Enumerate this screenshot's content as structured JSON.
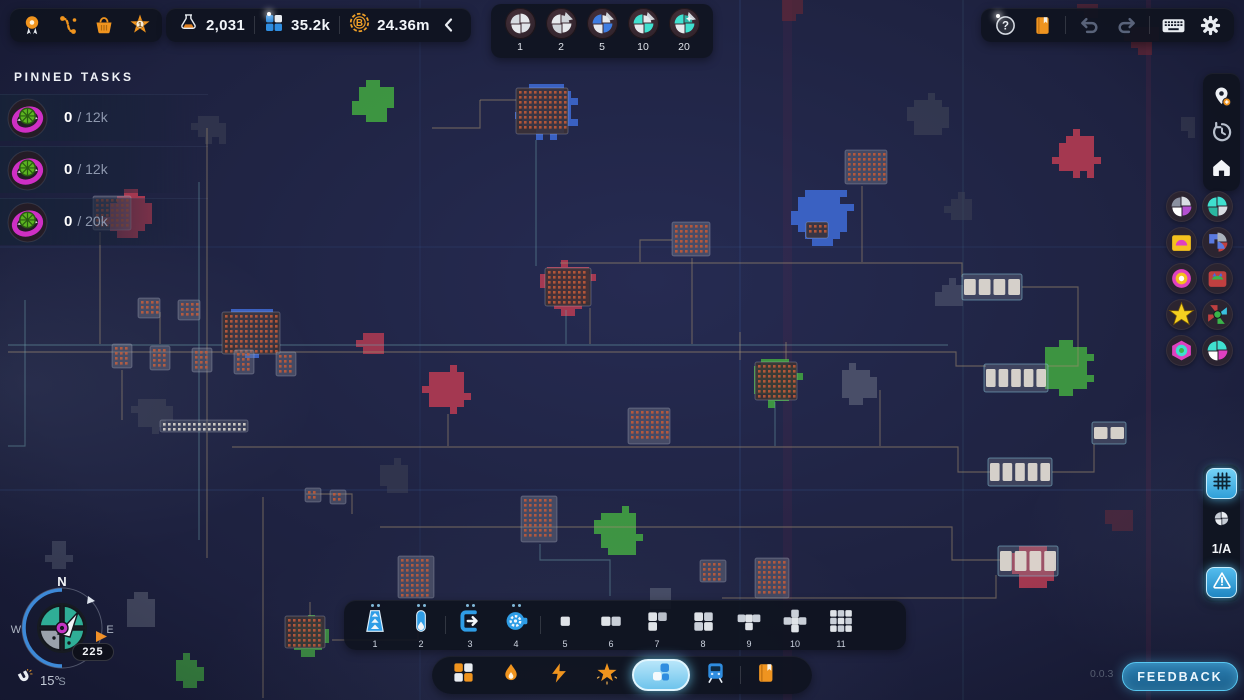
{
  "meta": {
    "version": "0.0.3"
  },
  "topbar": {
    "star_level": "1",
    "resources": {
      "research": "2,031",
      "shapes": "35.2k",
      "currency": "24.36m"
    }
  },
  "shape_selector": {
    "items": [
      {
        "label": "1",
        "colors": [
          "#e6e9ed",
          "#dfe3e8",
          "#e6e9ed",
          "#d6dbe1"
        ],
        "spike": false,
        "star": false
      },
      {
        "label": "2",
        "colors": [
          "#e6e9ed",
          "#cfd4da",
          "#e6e9ed",
          "#cfd4da"
        ],
        "spike": true,
        "star": false
      },
      {
        "label": "5",
        "colors": [
          "#3e7de2",
          "#e6e9ed",
          "#3e7de2",
          "#e6e9ed"
        ],
        "spike": true,
        "star": false
      },
      {
        "label": "10",
        "colors": [
          "#3fe0cf",
          "#e6e9ed",
          "#3fe0cf",
          "#e6e9ed"
        ],
        "spike": true,
        "star": false
      },
      {
        "label": "20",
        "colors": [
          "#3fe0cf",
          "#e6e9ed",
          "#3fe0cf",
          "#2ab6a8"
        ],
        "spike": true,
        "star": true
      }
    ]
  },
  "pinned": {
    "title": "PINNED TASKS",
    "tasks": [
      {
        "current": "0",
        "rest": "/ 12k"
      },
      {
        "current": "0",
        "rest": "/ 12k"
      },
      {
        "current": "0",
        "rest": "/ 20k"
      }
    ]
  },
  "right_panel": {
    "layer": "1/A",
    "badges": [
      {
        "colors": [
          "#d9dde3",
          "#b44fd0",
          "#ffffff",
          "#8a90a0"
        ],
        "type": "quad"
      },
      {
        "colors": [
          "#3fe0cf",
          "#d9dde3",
          "#2ab6a0",
          "#3fe0cf"
        ],
        "type": "quad"
      },
      {
        "colors": [
          "#f5c11e",
          "#e040c0",
          "#f5c11e",
          "#ffffff"
        ],
        "type": "quad"
      },
      {
        "colors": [
          "#5a7ae0",
          "#aab2bc",
          "#c04040",
          "#5a7ae0"
        ],
        "type": "quad"
      },
      {
        "colors": [
          "#e040c0",
          "#f5c11e",
          "#ffffff",
          "#e040c0"
        ],
        "type": "quad"
      },
      {
        "colors": [
          "#c04040",
          "#3ab54a",
          "#4a6ae0",
          "#c04040"
        ],
        "type": "quad"
      },
      {
        "colors": [
          "#f5d020"
        ],
        "type": "star"
      },
      {
        "colors": [
          "#c04040",
          "#39c0e0",
          "#3ab54a",
          "#c04040"
        ],
        "type": "quad"
      },
      {
        "colors": [
          "#e040c0",
          "#3fe0cf",
          "#3ab54a",
          "#e040c0"
        ],
        "type": "quad"
      },
      {
        "colors": [
          "#3fe0cf",
          "#e040c0",
          "#ffffff",
          "#3fe0cf"
        ],
        "type": "quad"
      }
    ]
  },
  "toolbar": {
    "items": [
      {
        "num": "1"
      },
      {
        "num": "2"
      },
      {
        "num": "3"
      },
      {
        "num": "4"
      },
      {
        "num": "5"
      },
      {
        "num": "6"
      },
      {
        "num": "7"
      },
      {
        "num": "8"
      },
      {
        "num": "9"
      },
      {
        "num": "10"
      },
      {
        "num": "11"
      }
    ]
  },
  "compass": {
    "n": "N",
    "w": "W",
    "e": "E",
    "s": "S",
    "heading": "225",
    "tilt": "15°"
  },
  "footer": {
    "feedback": "FEEDBACK"
  },
  "accents": {
    "blue": "#2f9de6",
    "orange": "#f0941e",
    "selected_glow": "#6ec4ec"
  },
  "map": {
    "colors": {
      "red": "#b23b52",
      "green": "#3f9b41",
      "blue": "#3c64c8",
      "gray": "#6a7082",
      "dgray": "#3f4456",
      "dred": "#6a2836"
    },
    "stripes": [
      {
        "x": 783,
        "w": 9,
        "a": 0.07
      },
      {
        "x": 1146,
        "w": 5,
        "a": 0.1
      }
    ],
    "grid": [
      {
        "v": 420,
        "a": 0.1
      },
      {
        "v": 740,
        "a": 0.2
      },
      {
        "v": 963,
        "a": 0.14,
        "t": "teal"
      },
      {
        "h": 247,
        "a": 0.13
      },
      {
        "h": 490,
        "a": 0.18
      }
    ],
    "blobs": [
      {
        "x": 375,
        "y": 103,
        "r": 20,
        "c": "green",
        "a": 0.95
      },
      {
        "x": 548,
        "y": 110,
        "r": 30,
        "c": "blue",
        "a": 0.95
      },
      {
        "x": 930,
        "y": 116,
        "r": 20,
        "c": "dgray",
        "a": 0.6
      },
      {
        "x": 1078,
        "y": 155,
        "r": 23,
        "c": "red",
        "a": 0.9
      },
      {
        "x": 1142,
        "y": 38,
        "r": 15,
        "c": "dred",
        "a": 0.7
      },
      {
        "x": 1188,
        "y": 124,
        "r": 11,
        "c": "dgray",
        "a": 0.5
      },
      {
        "x": 210,
        "y": 128,
        "r": 16,
        "c": "dgray",
        "a": 0.5
      },
      {
        "x": 130,
        "y": 216,
        "r": 24,
        "c": "red",
        "a": 0.9
      },
      {
        "x": 822,
        "y": 214,
        "r": 28,
        "c": "blue",
        "a": 0.95
      },
      {
        "x": 252,
        "y": 330,
        "r": 25,
        "c": "blue",
        "a": 0.95
      },
      {
        "x": 568,
        "y": 288,
        "r": 25,
        "c": "red",
        "a": 0.9
      },
      {
        "x": 372,
        "y": 342,
        "r": 13,
        "c": "red",
        "a": 0.85
      },
      {
        "x": 447,
        "y": 390,
        "r": 22,
        "c": "red",
        "a": 0.9
      },
      {
        "x": 152,
        "y": 413,
        "r": 18,
        "c": "dgray",
        "a": 0.55
      },
      {
        "x": 960,
        "y": 208,
        "r": 13,
        "c": "dgray",
        "a": 0.5
      },
      {
        "x": 775,
        "y": 380,
        "r": 25,
        "c": "green",
        "a": 0.95
      },
      {
        "x": 858,
        "y": 386,
        "r": 20,
        "c": "gray",
        "a": 0.55
      },
      {
        "x": 1068,
        "y": 370,
        "r": 27,
        "c": "green",
        "a": 0.95
      },
      {
        "x": 952,
        "y": 295,
        "r": 14,
        "c": "gray",
        "a": 0.4
      },
      {
        "x": 620,
        "y": 532,
        "r": 23,
        "c": "green",
        "a": 0.95
      },
      {
        "x": 392,
        "y": 477,
        "r": 16,
        "c": "dgray",
        "a": 0.5
      },
      {
        "x": 1032,
        "y": 566,
        "r": 24,
        "c": "red",
        "a": 0.9
      },
      {
        "x": 140,
        "y": 612,
        "r": 17,
        "c": "gray",
        "a": 0.5
      },
      {
        "x": 188,
        "y": 672,
        "r": 16,
        "c": "green",
        "a": 0.8
      },
      {
        "x": 310,
        "y": 638,
        "r": 20,
        "c": "green",
        "a": 0.85
      },
      {
        "x": 660,
        "y": 598,
        "r": 14,
        "c": "gray",
        "a": 0.5
      },
      {
        "x": 1122,
        "y": 520,
        "r": 14,
        "c": "dred",
        "a": 0.5
      },
      {
        "x": 790,
        "y": 8,
        "r": 12,
        "c": "dred",
        "a": 0.6
      },
      {
        "x": 1090,
        "y": 10,
        "r": 10,
        "c": "dred",
        "a": 0.6
      },
      {
        "x": 60,
        "y": 556,
        "r": 12,
        "c": "gray",
        "a": 0.4
      }
    ],
    "lines": [
      {
        "p": [
          [
            8,
            352
          ],
          [
            956,
            352
          ],
          [
            956,
            366
          ],
          [
            986,
            366
          ]
        ],
        "c": 1
      },
      {
        "p": [
          [
            8,
            345
          ],
          [
            948,
            345
          ]
        ],
        "c": 2
      },
      {
        "p": [
          [
            560,
            263
          ],
          [
            962,
            263
          ],
          [
            962,
            277
          ]
        ],
        "c": 1
      },
      {
        "p": [
          [
            232,
            447
          ],
          [
            958,
            447
          ],
          [
            958,
            472
          ],
          [
            990,
            472
          ]
        ],
        "c": 1
      },
      {
        "p": [
          [
            380,
            527
          ],
          [
            952,
            527
          ],
          [
            952,
            560
          ],
          [
            1000,
            560
          ]
        ],
        "c": 1
      },
      {
        "p": [
          [
            722,
            598
          ],
          [
            996,
            598
          ],
          [
            996,
            575
          ]
        ],
        "c": 1
      },
      {
        "p": [
          [
            207,
            128
          ],
          [
            207,
            558
          ]
        ],
        "c": 1
      },
      {
        "p": [
          [
            199,
            182
          ],
          [
            199,
            540
          ]
        ],
        "c": 2
      },
      {
        "p": [
          [
            263,
            497
          ],
          [
            263,
            698
          ]
        ],
        "c": 1
      },
      {
        "p": [
          [
            536,
            140
          ],
          [
            536,
            266
          ]
        ],
        "c": 2
      },
      {
        "p": [
          [
            692,
            258
          ],
          [
            692,
            344
          ]
        ],
        "c": 1
      },
      {
        "p": [
          [
            740,
            332
          ],
          [
            740,
            360
          ]
        ],
        "c": 1
      },
      {
        "p": [
          [
            786,
            342
          ],
          [
            786,
            360
          ]
        ],
        "c": 1
      },
      {
        "p": [
          [
            862,
            186
          ],
          [
            862,
            262
          ]
        ],
        "c": 1
      },
      {
        "p": [
          [
            100,
            232
          ],
          [
            100,
            344
          ]
        ],
        "c": 1
      },
      {
        "p": [
          [
            306,
            494
          ],
          [
            352,
            494
          ],
          [
            352,
            514
          ]
        ],
        "c": 1
      },
      {
        "p": [
          [
            418,
            600
          ],
          [
            418,
            640
          ],
          [
            332,
            640
          ]
        ],
        "c": 1
      },
      {
        "p": [
          [
            540,
            544
          ],
          [
            540,
            560
          ],
          [
            610,
            560
          ],
          [
            610,
            596
          ]
        ],
        "c": 2
      },
      {
        "p": [
          [
            1022,
            287
          ],
          [
            1078,
            287
          ],
          [
            1078,
            366
          ],
          [
            1048,
            366
          ]
        ],
        "c": 1
      },
      {
        "p": [
          [
            1052,
            472
          ],
          [
            1094,
            472
          ],
          [
            1094,
            444
          ]
        ],
        "c": 1
      },
      {
        "p": [
          [
            880,
            390
          ],
          [
            880,
            446
          ]
        ],
        "c": 1
      },
      {
        "p": [
          [
            25,
            300
          ],
          [
            25,
            446
          ],
          [
            8,
            446
          ]
        ],
        "c": 2
      },
      {
        "p": [
          [
            122,
            370
          ],
          [
            122,
            420
          ]
        ],
        "c": 1
      },
      {
        "p": [
          [
            160,
            312
          ],
          [
            160,
            344
          ]
        ],
        "c": 1
      },
      {
        "p": [
          [
            448,
            414
          ],
          [
            448,
            446
          ]
        ],
        "c": 1
      },
      {
        "p": [
          [
            590,
            308
          ],
          [
            590,
            344
          ]
        ],
        "c": 1
      },
      {
        "p": [
          [
            480,
            100
          ],
          [
            516,
            100
          ]
        ],
        "c": 1
      },
      {
        "p": [
          [
            480,
            100
          ],
          [
            480,
            128
          ],
          [
            432,
            128
          ]
        ],
        "c": 1
      },
      {
        "p": [
          [
            672,
            240
          ],
          [
            640,
            240
          ],
          [
            640,
            262
          ]
        ],
        "c": 1
      },
      {
        "p": [
          [
            775,
            402
          ],
          [
            775,
            446
          ]
        ],
        "c": 2
      },
      {
        "p": [
          [
            310,
            602
          ],
          [
            310,
            616
          ]
        ],
        "c": 1
      },
      {
        "p": [
          [
            566,
            310
          ],
          [
            566,
            344
          ]
        ],
        "c": 2
      }
    ],
    "platforms": [
      {
        "x": 516,
        "y": 88,
        "w": 52,
        "h": 46,
        "s": "mine"
      },
      {
        "x": 806,
        "y": 222,
        "w": 22,
        "h": 16,
        "s": "mine"
      },
      {
        "x": 222,
        "y": 312,
        "w": 58,
        "h": 42,
        "s": "mine"
      },
      {
        "x": 545,
        "y": 268,
        "w": 46,
        "h": 38,
        "s": "mine"
      },
      {
        "x": 672,
        "y": 222,
        "w": 38,
        "h": 34,
        "s": "pad"
      },
      {
        "x": 755,
        "y": 362,
        "w": 42,
        "h": 38,
        "s": "mine"
      },
      {
        "x": 628,
        "y": 408,
        "w": 42,
        "h": 36,
        "s": "pad"
      },
      {
        "x": 521,
        "y": 496,
        "w": 36,
        "h": 46,
        "s": "pad"
      },
      {
        "x": 398,
        "y": 556,
        "w": 36,
        "h": 42,
        "s": "pad"
      },
      {
        "x": 285,
        "y": 616,
        "w": 40,
        "h": 32,
        "s": "mine"
      },
      {
        "x": 845,
        "y": 150,
        "w": 42,
        "h": 34,
        "s": "pad"
      },
      {
        "x": 93,
        "y": 196,
        "w": 38,
        "h": 34,
        "s": "pad"
      },
      {
        "x": 755,
        "y": 558,
        "w": 34,
        "h": 40,
        "s": "pad"
      },
      {
        "x": 112,
        "y": 344,
        "w": 20,
        "h": 24,
        "s": "pad"
      },
      {
        "x": 150,
        "y": 346,
        "w": 20,
        "h": 24,
        "s": "pad"
      },
      {
        "x": 192,
        "y": 348,
        "w": 20,
        "h": 24,
        "s": "pad"
      },
      {
        "x": 234,
        "y": 350,
        "w": 20,
        "h": 24,
        "s": "pad"
      },
      {
        "x": 276,
        "y": 352,
        "w": 20,
        "h": 24,
        "s": "pad"
      },
      {
        "x": 138,
        "y": 298,
        "w": 22,
        "h": 20,
        "s": "pad"
      },
      {
        "x": 178,
        "y": 300,
        "w": 22,
        "h": 20,
        "s": "pad"
      },
      {
        "x": 305,
        "y": 488,
        "w": 16,
        "h": 14,
        "s": "pad"
      },
      {
        "x": 330,
        "y": 490,
        "w": 16,
        "h": 14,
        "s": "pad"
      },
      {
        "x": 160,
        "y": 420,
        "w": 88,
        "h": 12,
        "s": "strip"
      },
      {
        "x": 700,
        "y": 560,
        "w": 26,
        "h": 22,
        "s": "pad"
      }
    ],
    "stations": [
      {
        "x": 964,
        "y": 276,
        "w": 56,
        "h": 22,
        "n": 4
      },
      {
        "x": 986,
        "y": 366,
        "w": 60,
        "h": 24,
        "n": 5
      },
      {
        "x": 990,
        "y": 460,
        "w": 60,
        "h": 24,
        "n": 5
      },
      {
        "x": 1000,
        "y": 548,
        "w": 56,
        "h": 26,
        "n": 4
      },
      {
        "x": 1094,
        "y": 424,
        "w": 30,
        "h": 18,
        "n": 2
      }
    ]
  }
}
